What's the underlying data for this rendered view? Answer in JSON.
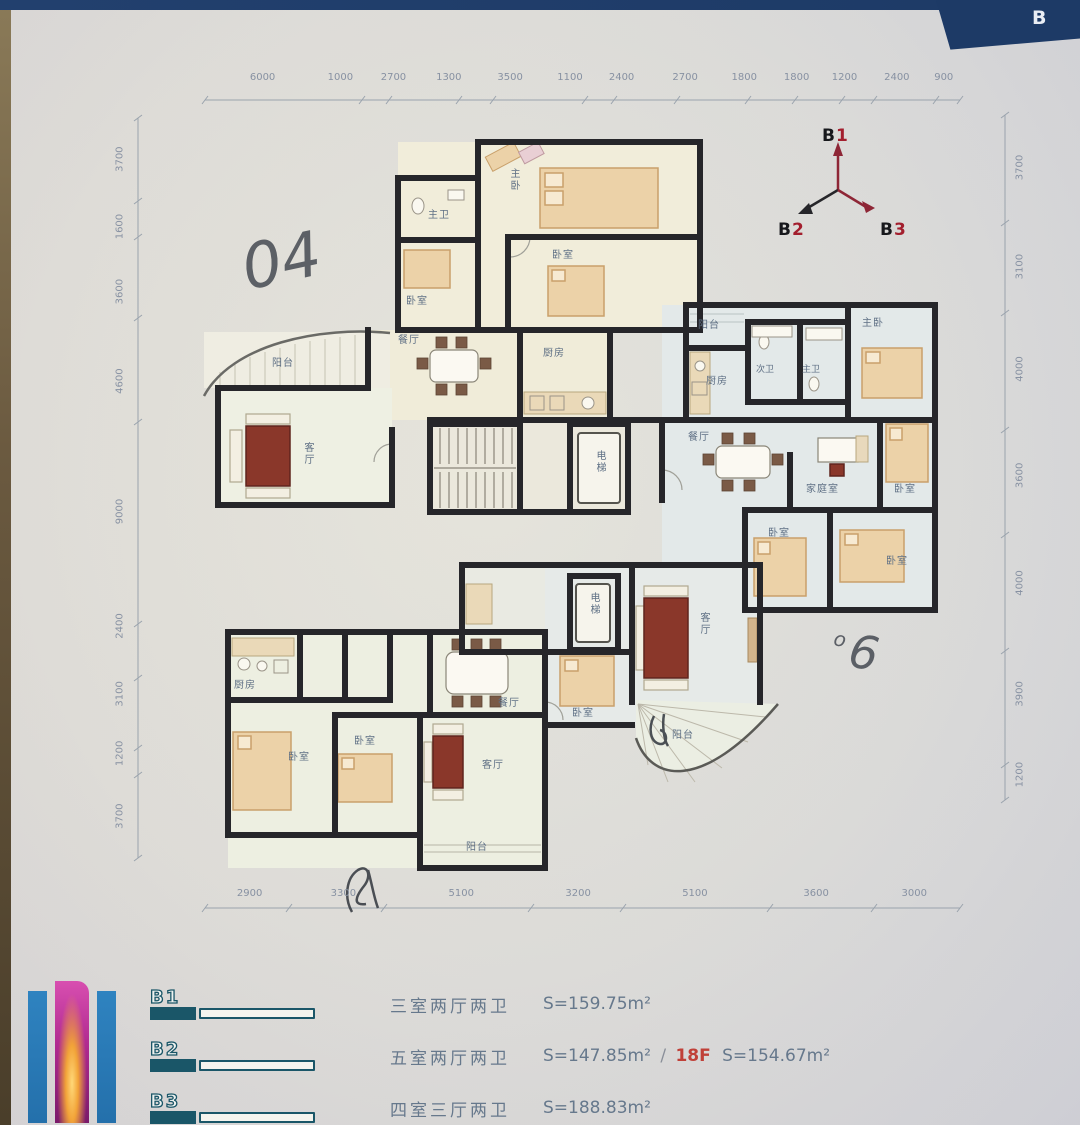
{
  "header": {
    "corner_letter": "B"
  },
  "compass": {
    "items": [
      {
        "letter": "B",
        "digit": "1"
      },
      {
        "letter": "B",
        "digit": "2"
      },
      {
        "letter": "B",
        "digit": "3"
      }
    ]
  },
  "dimensions": {
    "top": [
      "6000",
      "1000",
      "2700",
      "1300",
      "3500",
      "1100",
      "2400",
      "2700",
      "1800",
      "1800",
      "1200",
      "2400",
      "900"
    ],
    "bottom": [
      "2900",
      "3300",
      "5100",
      "3200",
      "5100",
      "3600",
      "3000"
    ],
    "left": [
      "3700",
      "1600",
      "3600",
      "4600",
      "9000",
      "2400",
      "3100",
      "1200",
      "3700"
    ],
    "right": [
      "3700",
      "3100",
      "4000",
      "3600",
      "4000",
      "3900",
      "1200"
    ]
  },
  "rooms": {
    "a_master": "主卧",
    "a_bath": "主卫",
    "a_bed1": "卧室",
    "a_bed2": "卧室",
    "a_balcony": "阳台",
    "a_dining": "餐厅",
    "a_kitchen": "厨房",
    "a_living": "客厅",
    "elevator1": "电梯",
    "elevator2": "电梯",
    "b_balcony": "阳台",
    "b_kitchen": "厨房",
    "b_bath2": "次卫",
    "b_bath1": "主卫",
    "b_master": "主卧",
    "b_dining": "餐厅",
    "b_family": "家庭室",
    "b_bed1": "卧室",
    "b_bed2": "卧室",
    "b_bed3": "卧室",
    "c_kitchen": "厨房",
    "c_dining": "餐厅",
    "c_bed1": "卧室",
    "c_bed2": "卧室",
    "c_living": "客厅",
    "c_balcony": "阳台",
    "d_bed1": "卧室",
    "d_living": "客厅",
    "d_balcony": "阳台"
  },
  "annotations": {
    "handwritten_left": "04",
    "handwritten_right_prefix": "o",
    "handwritten_right": "6"
  },
  "legend": {
    "items": [
      {
        "code": "B1",
        "type": "三室两厅两卫",
        "area": "S=159.75m²"
      },
      {
        "code": "B2",
        "type": "五室两厅两卫",
        "area": "S=147.85m²",
        "separator": "/",
        "floor_note": "18F",
        "area_alt": "S=154.67m²"
      },
      {
        "code": "B3",
        "type": "四室三厅两卫",
        "area": "S=188.83m²"
      }
    ]
  }
}
